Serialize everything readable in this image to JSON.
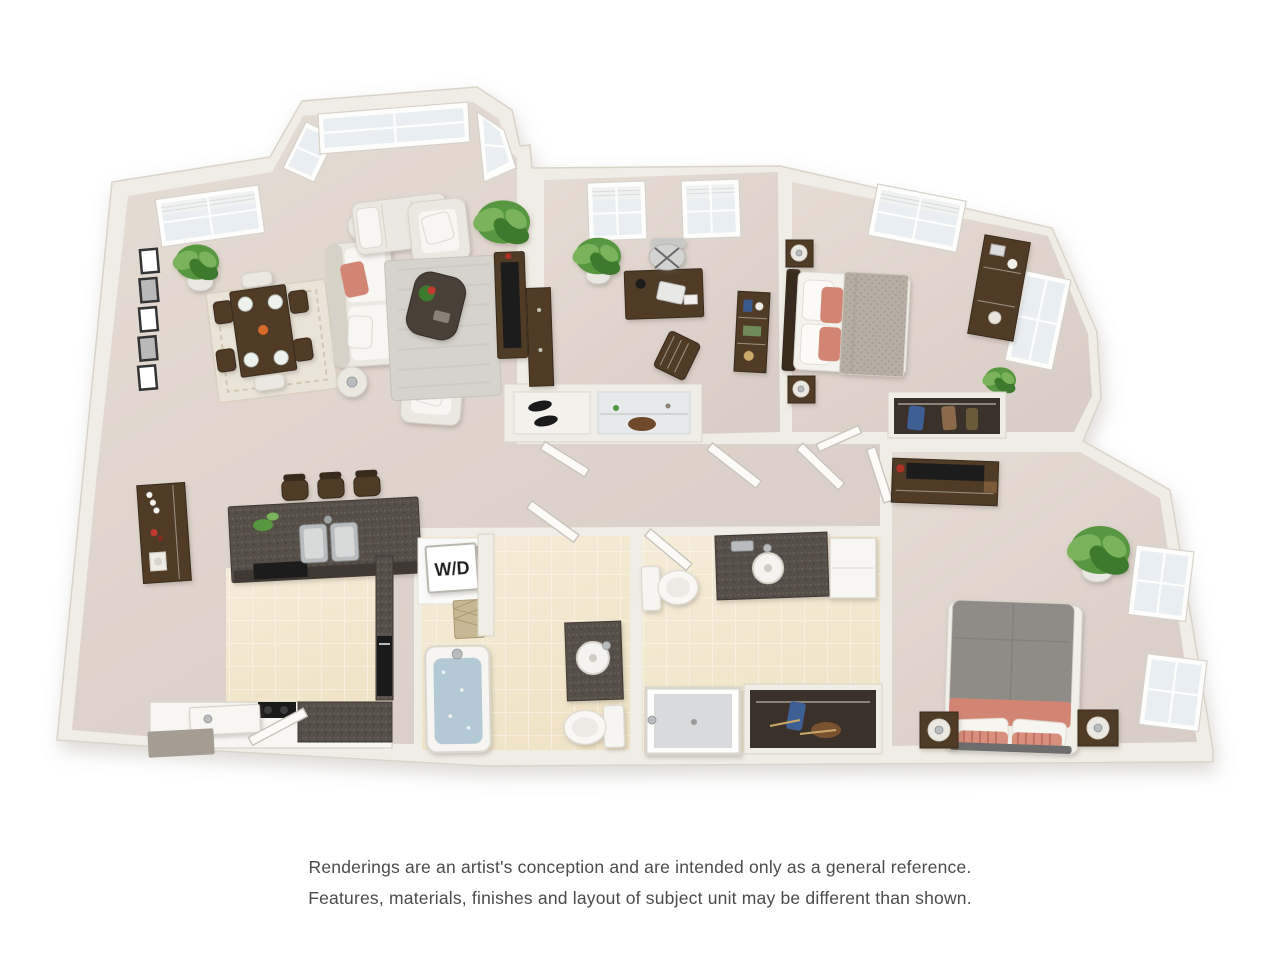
{
  "labels": {
    "washer_dryer": "W/D"
  },
  "disclaimer": {
    "line1": "Renderings are an artist's conception and are intended only as a general reference.",
    "line2": "Features, materials, finishes and layout of subject unit may be different than shown."
  },
  "colors": {
    "wall": "#f0ede6",
    "wallEdge": "#d9d4c9",
    "floor": "#d9cec7",
    "floorLight": "#e5dcd4",
    "tile": "#f0e3c8",
    "tileLight": "#f5ecd8",
    "granite": "#57504a",
    "graniteFleck": "#6f675e",
    "graniteDark": "#3f3933",
    "wood": "#4f3a27",
    "woodDark": "#392a1a",
    "cream": "#ebe8e1",
    "creamDark": "#d6d2c8",
    "coral": "#d28573",
    "coralDeep": "#c06a56",
    "duvetKnit": "#b6aea3",
    "duvetKnitDot": "#a39b8f",
    "duvetGray": "#8f8c88",
    "plantDeep": "#3e7a2e",
    "plantMid": "#57973f",
    "plantLight": "#7ab35b",
    "rugGray": "#d6d3cd",
    "rugCream": "#eae4d8",
    "water": "#b4c9d6",
    "glass": "#e9eef2",
    "windowFrame": "#fdfdfc",
    "fixture": "#f7f6f2",
    "fixtureLine": "#d6d2ca",
    "closetDark": "#3a322a",
    "black": "#1a1a1a",
    "metal": "#b9bcbe",
    "mat": "#a59d92",
    "hamper": "#c8b794",
    "hamperLine": "#ab9972",
    "door": "#fbfaf7",
    "doorStroke": "#c8c4bb",
    "text": "#4b4b4b"
  }
}
